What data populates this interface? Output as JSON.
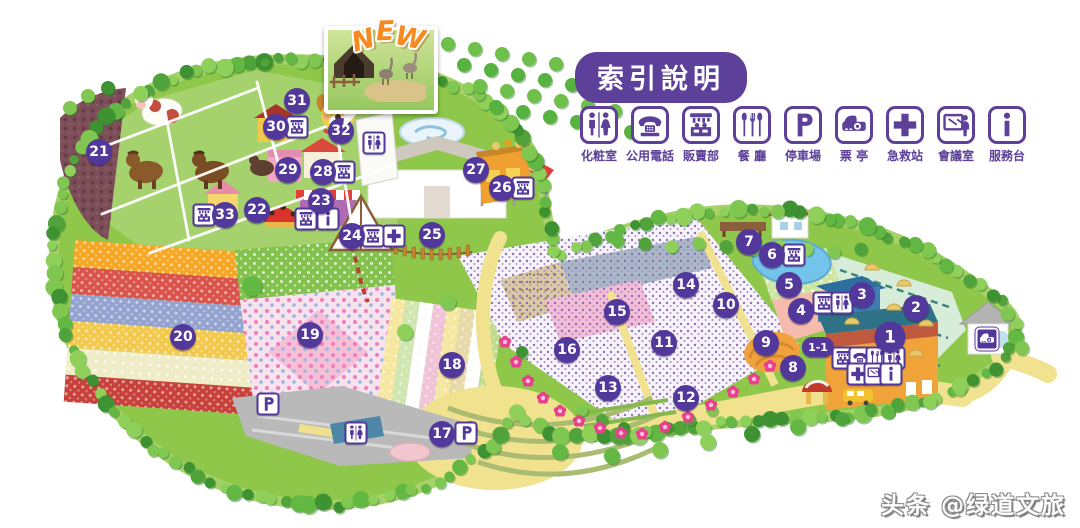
{
  "legend": {
    "title": "索引說明",
    "items": [
      {
        "id": "restroom",
        "label": "化粧室"
      },
      {
        "id": "phone",
        "label": "公用電話"
      },
      {
        "id": "shop",
        "label": "販賣部"
      },
      {
        "id": "restaurant",
        "label": "餐 廳"
      },
      {
        "id": "parking",
        "label": "停車場"
      },
      {
        "id": "ticket",
        "label": "票 亭"
      },
      {
        "id": "firstaid",
        "label": "急救站"
      },
      {
        "id": "meeting",
        "label": "會議室"
      },
      {
        "id": "info",
        "label": "服務台"
      }
    ]
  },
  "map": {
    "new_badge": "NEW",
    "markers": [
      {
        "id": "1",
        "x": 890,
        "y": 337,
        "size": "big"
      },
      {
        "id": "1-1",
        "x": 818,
        "y": 347,
        "size": "pill"
      },
      {
        "id": "2",
        "x": 916,
        "y": 308
      },
      {
        "id": "3",
        "x": 862,
        "y": 295
      },
      {
        "id": "4",
        "x": 801,
        "y": 311
      },
      {
        "id": "5",
        "x": 789,
        "y": 285
      },
      {
        "id": "6",
        "x": 772,
        "y": 255
      },
      {
        "id": "7",
        "x": 749,
        "y": 242
      },
      {
        "id": "8",
        "x": 793,
        "y": 368
      },
      {
        "id": "9",
        "x": 766,
        "y": 343
      },
      {
        "id": "10",
        "x": 726,
        "y": 305
      },
      {
        "id": "11",
        "x": 664,
        "y": 343
      },
      {
        "id": "12",
        "x": 686,
        "y": 398
      },
      {
        "id": "13",
        "x": 608,
        "y": 388
      },
      {
        "id": "14",
        "x": 686,
        "y": 285
      },
      {
        "id": "15",
        "x": 617,
        "y": 312
      },
      {
        "id": "16",
        "x": 567,
        "y": 350
      },
      {
        "id": "17",
        "x": 442,
        "y": 434
      },
      {
        "id": "18",
        "x": 452,
        "y": 365
      },
      {
        "id": "19",
        "x": 310,
        "y": 335
      },
      {
        "id": "20",
        "x": 183,
        "y": 337
      },
      {
        "id": "21",
        "x": 99,
        "y": 152
      },
      {
        "id": "22",
        "x": 257,
        "y": 210
      },
      {
        "id": "23",
        "x": 321,
        "y": 201
      },
      {
        "id": "24",
        "x": 352,
        "y": 236
      },
      {
        "id": "25",
        "x": 432,
        "y": 235
      },
      {
        "id": "26",
        "x": 502,
        "y": 188
      },
      {
        "id": "27",
        "x": 476,
        "y": 170
      },
      {
        "id": "28",
        "x": 323,
        "y": 172
      },
      {
        "id": "29",
        "x": 288,
        "y": 170
      },
      {
        "id": "30",
        "x": 276,
        "y": 127
      },
      {
        "id": "31",
        "x": 297,
        "y": 101
      },
      {
        "id": "32",
        "x": 341,
        "y": 131
      },
      {
        "id": "33",
        "x": 225,
        "y": 215
      }
    ],
    "facility_points": [
      {
        "type": "restroom",
        "x": 374,
        "y": 143
      },
      {
        "type": "shop",
        "x": 297,
        "y": 127
      },
      {
        "type": "shop",
        "x": 344,
        "y": 172
      },
      {
        "type": "shop",
        "x": 204,
        "y": 215
      },
      {
        "type": "shop",
        "x": 306,
        "y": 219
      },
      {
        "type": "info",
        "x": 328,
        "y": 219
      },
      {
        "type": "shop",
        "x": 373,
        "y": 236
      },
      {
        "type": "firstaid",
        "x": 394,
        "y": 236
      },
      {
        "type": "shop",
        "x": 523,
        "y": 188
      },
      {
        "type": "shop",
        "x": 794,
        "y": 255
      },
      {
        "type": "shop",
        "x": 824,
        "y": 303
      },
      {
        "type": "restroom",
        "x": 842,
        "y": 303
      },
      {
        "type": "shop",
        "x": 843,
        "y": 358
      },
      {
        "type": "phone",
        "x": 860,
        "y": 358
      },
      {
        "type": "restaurant",
        "x": 877,
        "y": 358
      },
      {
        "type": "restroom",
        "x": 894,
        "y": 358
      },
      {
        "type": "firstaid",
        "x": 858,
        "y": 374
      },
      {
        "type": "meeting",
        "x": 875,
        "y": 374
      },
      {
        "type": "info",
        "x": 891,
        "y": 374
      },
      {
        "type": "parking",
        "x": 268,
        "y": 404
      },
      {
        "type": "restroom",
        "x": 356,
        "y": 433
      },
      {
        "type": "parking",
        "x": 466,
        "y": 433
      },
      {
        "type": "ticket",
        "x": 987,
        "y": 339,
        "variant": "solid"
      }
    ]
  },
  "watermark": "头条 @绿道文旅",
  "colors": {
    "marker": "#53389B",
    "legend_purple": "#5C4099",
    "new_orange": "#F6891F",
    "grass": "#8FC74B",
    "sand": "#F0E28E"
  }
}
